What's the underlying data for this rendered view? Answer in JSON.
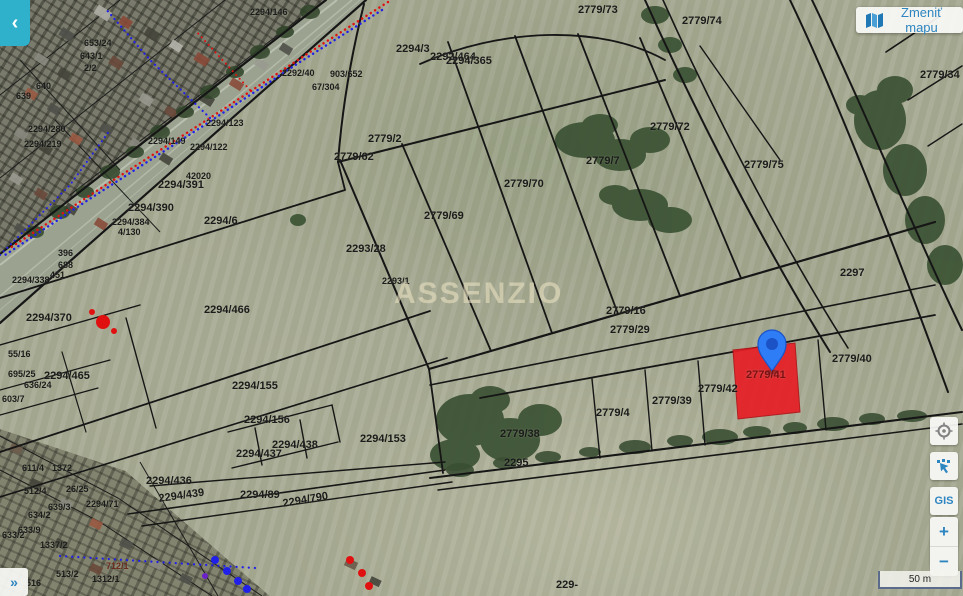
{
  "header": {
    "back_glyph": "‹",
    "change_map_label": "Zmeniť mapu"
  },
  "toolbar": {
    "gis_label": "GIS",
    "zoom_in_label": "+",
    "zoom_out_label": "−"
  },
  "footer": {
    "expand_glyph": "»",
    "scale_label": "50 m"
  },
  "watermark": "ASSENZIO",
  "map": {
    "selected_parcel": "2779/41",
    "colors": {
      "selection_red": "#e61e25",
      "pin_blue": "#2e7cf6",
      "accent_teal": "#2fb0cb",
      "link_blue": "#2e86c1",
      "boundary_black": "#161616"
    },
    "labels": [
      {
        "t": "2779/73",
        "x": 578,
        "y": 5
      },
      {
        "t": "2779/74",
        "x": 682,
        "y": 16
      },
      {
        "t": "2779/34",
        "x": 920,
        "y": 70
      },
      {
        "t": "2292/464",
        "x": 430,
        "y": 52
      },
      {
        "t": "2294/3",
        "x": 396,
        "y": 44
      },
      {
        "t": "2294/365",
        "x": 446,
        "y": 56
      },
      {
        "t": "2294/146",
        "x": 250,
        "y": 8,
        "s": 9
      },
      {
        "t": "2292/40",
        "x": 282,
        "y": 69,
        "s": 9
      },
      {
        "t": "903/652",
        "x": 330,
        "y": 70,
        "s": 9
      },
      {
        "t": "67/304",
        "x": 312,
        "y": 83,
        "s": 9
      },
      {
        "t": "653/24",
        "x": 84,
        "y": 39,
        "s": 9
      },
      {
        "t": "643/1",
        "x": 80,
        "y": 52,
        "s": 9
      },
      {
        "t": "2/2",
        "x": 84,
        "y": 64,
        "s": 9
      },
      {
        "t": "640",
        "x": 36,
        "y": 82,
        "s": 9
      },
      {
        "t": "639",
        "x": 16,
        "y": 92,
        "s": 9
      },
      {
        "t": "2294/280",
        "x": 28,
        "y": 125,
        "s": 9
      },
      {
        "t": "2294/219",
        "x": 24,
        "y": 140,
        "s": 9
      },
      {
        "t": "2294/123",
        "x": 206,
        "y": 119,
        "s": 9
      },
      {
        "t": "2294/149",
        "x": 148,
        "y": 137,
        "s": 9
      },
      {
        "t": "2294/122",
        "x": 190,
        "y": 143,
        "s": 9
      },
      {
        "t": "42020",
        "x": 186,
        "y": 172,
        "s": 9
      },
      {
        "t": "2294/391",
        "x": 158,
        "y": 180
      },
      {
        "t": "2294/390",
        "x": 128,
        "y": 203
      },
      {
        "t": "2294/384",
        "x": 112,
        "y": 218,
        "s": 9
      },
      {
        "t": "4/130",
        "x": 118,
        "y": 228,
        "s": 9
      },
      {
        "t": "396",
        "x": 58,
        "y": 249,
        "s": 9
      },
      {
        "t": "688",
        "x": 58,
        "y": 261,
        "s": 9
      },
      {
        "t": "451",
        "x": 50,
        "y": 271,
        "s": 9
      },
      {
        "t": "2294/338",
        "x": 12,
        "y": 276,
        "s": 9
      },
      {
        "t": "2294/370",
        "x": 26,
        "y": 313
      },
      {
        "t": "55/16",
        "x": 8,
        "y": 350,
        "s": 9
      },
      {
        "t": "695/25",
        "x": 8,
        "y": 370,
        "s": 9
      },
      {
        "t": "2294/465",
        "x": 44,
        "y": 371
      },
      {
        "t": "636/24",
        "x": 24,
        "y": 381,
        "s": 9
      },
      {
        "t": "603/7",
        "x": 2,
        "y": 395,
        "s": 9
      },
      {
        "t": "2294/466",
        "x": 204,
        "y": 305
      },
      {
        "t": "2294/6",
        "x": 204,
        "y": 216
      },
      {
        "t": "2293/28",
        "x": 346,
        "y": 244
      },
      {
        "t": "2293/1",
        "x": 382,
        "y": 277,
        "s": 9
      },
      {
        "t": "2779/2",
        "x": 368,
        "y": 134
      },
      {
        "t": "2779/62",
        "x": 334,
        "y": 152
      },
      {
        "t": "2779/69",
        "x": 424,
        "y": 211
      },
      {
        "t": "2779/70",
        "x": 504,
        "y": 179
      },
      {
        "t": "2779/7",
        "x": 586,
        "y": 156
      },
      {
        "t": "2779/72",
        "x": 650,
        "y": 122
      },
      {
        "t": "2779/75",
        "x": 744,
        "y": 160
      },
      {
        "t": "2297",
        "x": 840,
        "y": 268
      },
      {
        "t": "2779/16",
        "x": 606,
        "y": 306
      },
      {
        "t": "2779/29",
        "x": 610,
        "y": 325
      },
      {
        "t": "2779/40",
        "x": 832,
        "y": 354
      },
      {
        "t": "2779/41",
        "x": 746,
        "y": 370,
        "c": "#7c1114"
      },
      {
        "t": "2779/42",
        "x": 698,
        "y": 384
      },
      {
        "t": "2779/39",
        "x": 652,
        "y": 396
      },
      {
        "t": "2779/4",
        "x": 596,
        "y": 408
      },
      {
        "t": "2779/38",
        "x": 500,
        "y": 429
      },
      {
        "t": "2295",
        "x": 504,
        "y": 458
      },
      {
        "t": "2294/153",
        "x": 360,
        "y": 434
      },
      {
        "t": "2294/155",
        "x": 232,
        "y": 381
      },
      {
        "t": "2294/156",
        "x": 244,
        "y": 415
      },
      {
        "t": "2294/438",
        "x": 272,
        "y": 440
      },
      {
        "t": "2294/437",
        "x": 236,
        "y": 449
      },
      {
        "t": "2294/436",
        "x": 146,
        "y": 476
      },
      {
        "t": "2294/439",
        "x": 158,
        "y": 494,
        "r": -8
      },
      {
        "t": "2294/89",
        "x": 240,
        "y": 490
      },
      {
        "t": "2294/790",
        "x": 282,
        "y": 499,
        "r": -10
      },
      {
        "t": "2294/71",
        "x": 86,
        "y": 500,
        "s": 9
      },
      {
        "t": "611/4",
        "x": 22,
        "y": 464,
        "s": 9
      },
      {
        "t": "1372",
        "x": 52,
        "y": 464,
        "s": 9
      },
      {
        "t": "26/25",
        "x": 66,
        "y": 485,
        "s": 9
      },
      {
        "t": "512/4",
        "x": 24,
        "y": 487,
        "s": 9
      },
      {
        "t": "639/3",
        "x": 48,
        "y": 503,
        "s": 9
      },
      {
        "t": "634/2",
        "x": 28,
        "y": 511,
        "s": 9
      },
      {
        "t": "633/9",
        "x": 18,
        "y": 526,
        "s": 9
      },
      {
        "t": "633/2",
        "x": 2,
        "y": 531,
        "s": 9
      },
      {
        "t": "1337/2",
        "x": 40,
        "y": 541,
        "s": 9
      },
      {
        "t": "712/1",
        "x": 106,
        "y": 562,
        "s": 9,
        "c": "#6b2a1e"
      },
      {
        "t": "513/2",
        "x": 56,
        "y": 570,
        "s": 9
      },
      {
        "t": "1312/1",
        "x": 92,
        "y": 575,
        "s": 9
      },
      {
        "t": "516",
        "x": 26,
        "y": 579,
        "s": 9
      },
      {
        "t": "229-",
        "x": 556,
        "y": 580
      }
    ]
  }
}
